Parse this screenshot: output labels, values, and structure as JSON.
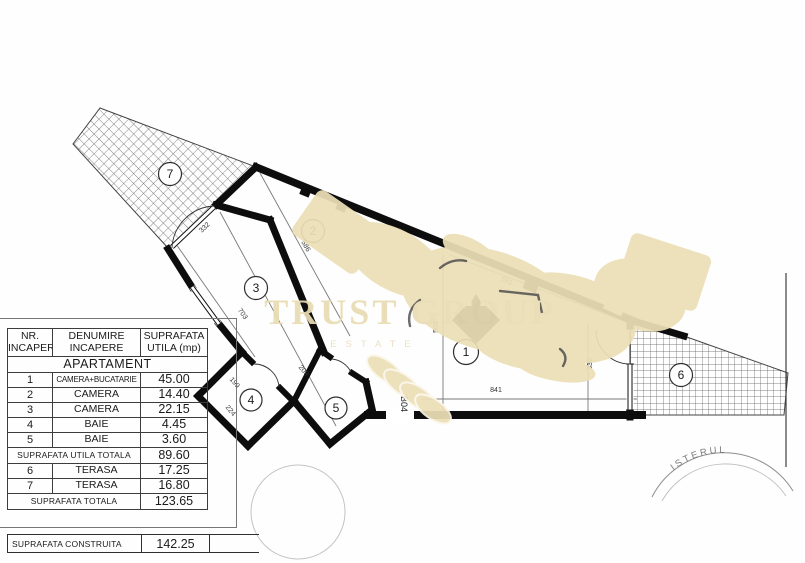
{
  "table": {
    "headers": {
      "col1": "NR. INCAPERE",
      "col2": "DENUMIRE INCAPERE",
      "col3": "SUPRAFATA UTILA (mp)"
    },
    "section_title": "APARTAMENT",
    "rows": [
      {
        "nr": "1",
        "name": "CAMERA+BUCATARIE",
        "area": "45.00"
      },
      {
        "nr": "2",
        "name": "CAMERA",
        "area": "14.40"
      },
      {
        "nr": "3",
        "name": "CAMERA",
        "area": "22.15"
      },
      {
        "nr": "4",
        "name": "BAIE",
        "area": "4.45"
      },
      {
        "nr": "5",
        "name": "BAIE",
        "area": "3.60"
      }
    ],
    "useful_total": {
      "label": "SUPRAFATA UTILA TOTALA",
      "value": "89.60"
    },
    "terrace_rows": [
      {
        "nr": "6",
        "name": "TERASA",
        "area": "17.25"
      },
      {
        "nr": "7",
        "name": "TERASA",
        "area": "16.80"
      }
    ],
    "total": {
      "label": "SUPRAFATA TOTALA",
      "value": "123.65"
    },
    "built": {
      "label": "SUPRAFATA CONSTRUITA",
      "value": "142.25"
    }
  },
  "plan": {
    "rooms": {
      "r1": "1",
      "r2": "2",
      "r3": "3",
      "r4": "4",
      "r5": "5",
      "r6": "6",
      "r7": "7"
    },
    "dimensions": {
      "d332": "332",
      "d586": "586",
      "d703": "703",
      "d199": "199",
      "d224": "224",
      "d209": "209",
      "d581": "581",
      "d508": "508",
      "d841": "841",
      "d330": "330"
    },
    "unit_label": "B04"
  },
  "watermark": {
    "title": "TRUST GROUP",
    "subtitle": "ESTATE",
    "color": "#e8dcb2"
  },
  "stamp": {
    "text": "ISTERUL"
  }
}
